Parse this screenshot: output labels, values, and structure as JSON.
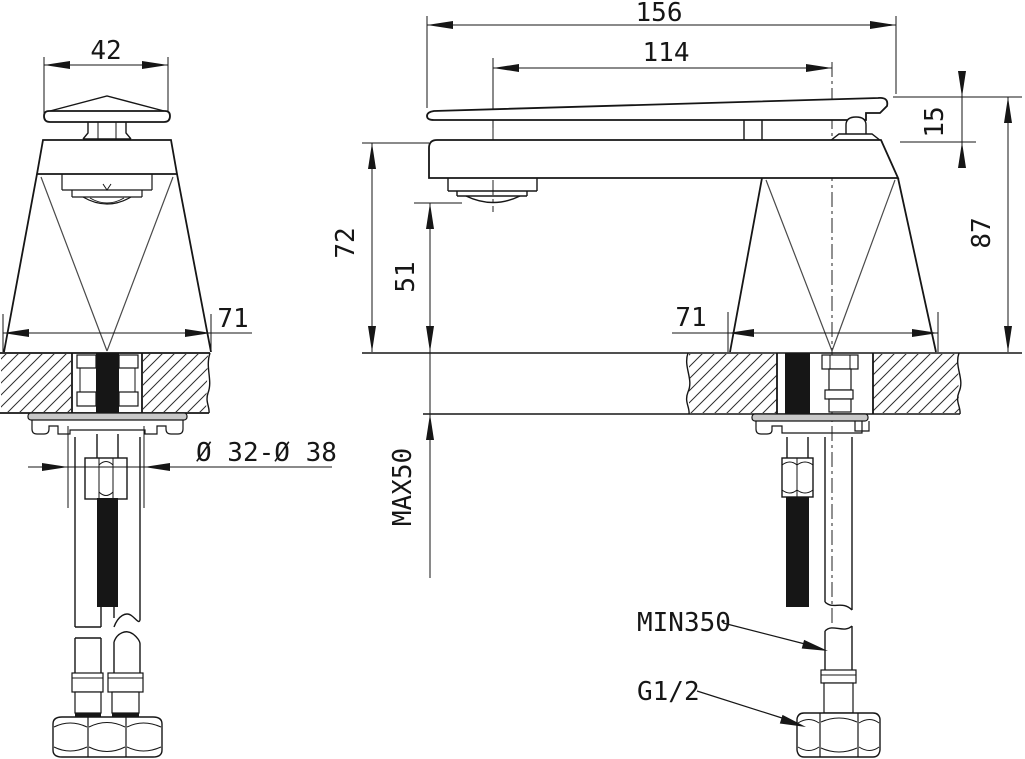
{
  "drawing": {
    "type": "technical-installation-drawing",
    "subject": "basin mixer faucet, front and side views with mounting section",
    "background": "#ffffff",
    "line_color": "#161616"
  },
  "dimensions": {
    "front": {
      "handle_width": "42",
      "base_diameter": "71",
      "hole_diameter": "Ø 32-Ø 38"
    },
    "side": {
      "overall_length": "156",
      "spout_reach": "114",
      "lever_rise": "15",
      "height_above_deck": "87",
      "body_height": "72",
      "spout_clearance": "51",
      "base_diameter": "71",
      "deck_thickness_max": "MAX50",
      "hose_length_min": "MIN350",
      "thread_size": "G1/2"
    }
  }
}
